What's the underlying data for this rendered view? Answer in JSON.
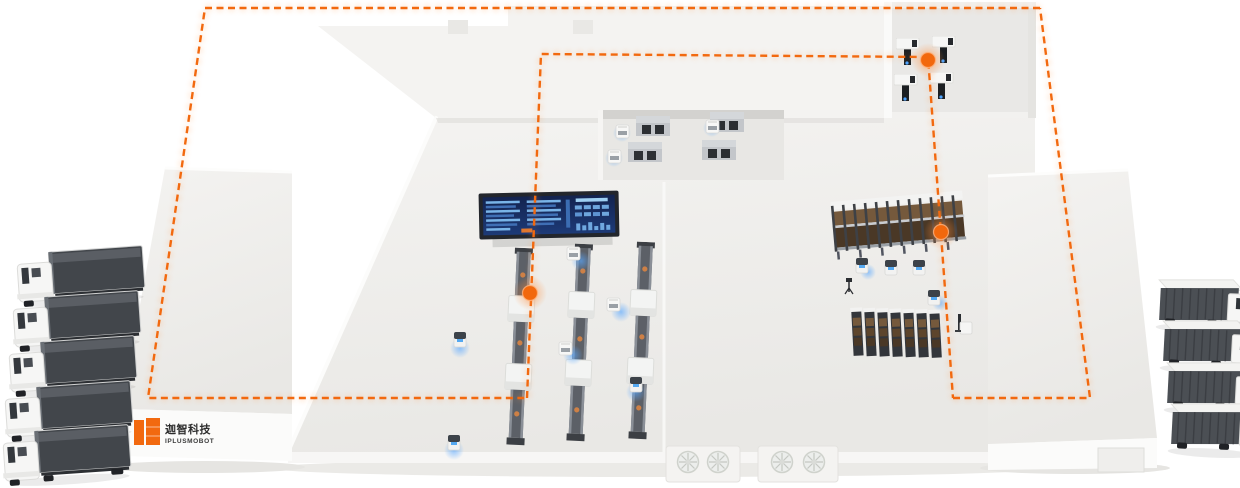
{
  "scene": {
    "title": "Smart factory isometric overview",
    "description": "Isometric rendering of an intelligent logistics facility with AMR route network, docking trucks, conveyor lines, pallet racks, machine bays and a monitoring dashboard"
  },
  "theme": {
    "accent": "#f2690f",
    "route": "#f2690f",
    "route_glow": "#ff9a4d",
    "floor_light": "#f3f2f0",
    "floor_shade": "#e9e8e5",
    "glow_blue": "#5aa8ff",
    "trailer_dark": "#42464b",
    "screen_navy": "#16255c",
    "screen_row_blue": "#79b4e8",
    "rack_box_brown": "#75593c",
    "logo_orange": "#f2690f"
  },
  "logo": {
    "brand_cn": "迦智科技",
    "brand_en": "IPLUSMOBOT"
  },
  "fleet": {
    "trucks_left": {
      "count": 5,
      "type": "semi-truck-with-dark-container"
    },
    "trucks_right": {
      "count": 4,
      "type": "box-truck-white-roof"
    },
    "amr_robots": {
      "count": 10,
      "type": "mobile-robot-with-blue-glow"
    }
  },
  "facility": {
    "zones": [
      {
        "id": "left-dock-slab",
        "label": "branded dock slab (logo face)"
      },
      {
        "id": "machining-bay-top",
        "machines": 4
      },
      {
        "id": "cnc-room-top-right",
        "machines": 4
      },
      {
        "id": "conveyor-lines-center",
        "lines": 3
      },
      {
        "id": "pallet-rack-upper",
        "sections": 11
      },
      {
        "id": "pallet-rack-lower",
        "sections": 7
      },
      {
        "id": "control-dashboard",
        "panels": [
          "table",
          "table",
          "stats"
        ]
      },
      {
        "id": "right-dock-slab"
      },
      {
        "id": "vent-blocks-front",
        "fans": 4
      }
    ]
  },
  "routes": {
    "style": "dashed",
    "color": "#f2690f",
    "segments": [
      {
        "id": "outer-left",
        "points": "1040,8 205,8 148,398 527,398"
      },
      {
        "id": "inner-loop",
        "points": "527,398 541,54 928,57 953,398"
      },
      {
        "id": "outer-right",
        "points": "953,398 1090,398 1040,8"
      }
    ],
    "waypoints": [
      {
        "transform": "translate(530,293)"
      },
      {
        "transform": "translate(928,60)"
      },
      {
        "transform": "translate(941,232)"
      }
    ]
  }
}
